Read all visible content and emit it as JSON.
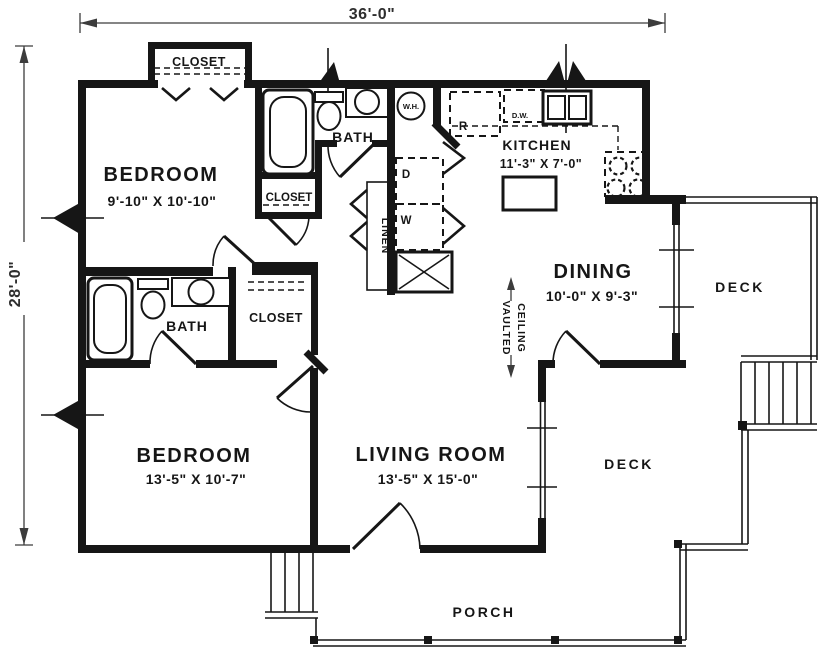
{
  "dimensions": {
    "overall_width": "36'-0\"",
    "overall_height": "28'-0\""
  },
  "rooms": {
    "bedroom_top": {
      "label": "BEDROOM",
      "size": "9'-10\" X 10'-10\""
    },
    "bedroom_bottom": {
      "label": "BEDROOM",
      "size": "13'-5\" X 10'-7\""
    },
    "living_room": {
      "label": "LIVING ROOM",
      "size": "13'-5\" X 15'-0\""
    },
    "dining": {
      "label": "DINING",
      "size": "10'-0\" X 9'-3\""
    },
    "kitchen": {
      "label": "KITCHEN",
      "size": "11'-3\" X 7'-0\""
    },
    "bath_top": {
      "label": "BATH"
    },
    "bath_bottom": {
      "label": "BATH"
    },
    "closet_entry": {
      "label": "CLOSET"
    },
    "closet_hall": {
      "label": "CLOSET"
    },
    "closet_bedroom": {
      "label": "CLOSET"
    },
    "linen": {
      "label": "LINEN"
    },
    "deck_upper": {
      "label": "DECK"
    },
    "deck_lower": {
      "label": "DECK"
    },
    "porch": {
      "label": "PORCH"
    }
  },
  "annotations": {
    "vaulted_line1": "VAULTED",
    "vaulted_line2": "CEILING",
    "water_heater": "W.H.",
    "refrigerator": "R",
    "dishwasher": "D.W.",
    "dryer": "D",
    "washer": "W"
  },
  "colors": {
    "line": "#161616",
    "background": "#ffffff",
    "dimension": "#3c3c3c"
  }
}
